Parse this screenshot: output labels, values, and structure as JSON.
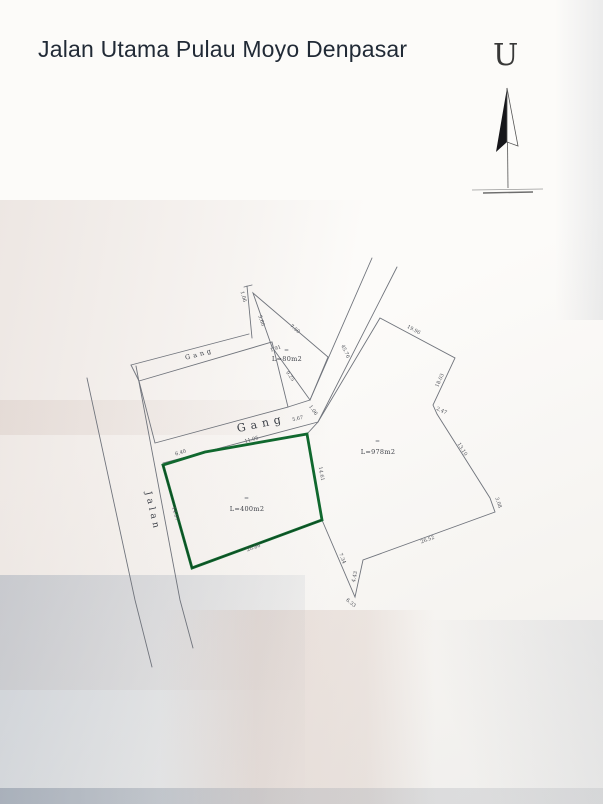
{
  "title": "Jalan Utama Pulau Moyo Denpasar",
  "north": {
    "label": "U"
  },
  "roads": {
    "jalan": "Jalan",
    "gang_top": "Gang",
    "gang_mid": "Gang",
    "road_length": "45.76"
  },
  "plots": {
    "green": {
      "area": "L=400m2",
      "dim_top_left": "6.40",
      "dim_top": "11.05",
      "dim_right": "14.61",
      "dim_bottom": "20.86",
      "dim_left": "14.97"
    },
    "east": {
      "area": "L=978m2",
      "dim_north": "19.96",
      "dim_northeast": "18.03",
      "dim_jog": "2.47",
      "dim_east": "13.10",
      "dim_southeast": "3.08",
      "dim_south": "26.52",
      "dim_southwest": "4.43",
      "dim_vertex": "6.33",
      "dim_west": "7.34"
    },
    "small": {
      "area": "L=80m2",
      "dim_corridor": "1.06",
      "dim_left": "5.60",
      "dim_hyp": "7.50",
      "dim_inner": "1.91",
      "dim_bottom": "9.25"
    },
    "gang_edge": {
      "dim_a": "5.67",
      "dim_b": "1.06"
    }
  },
  "colors": {
    "plot_highlight": "#10682e",
    "ink": "#70747c",
    "title_text": "#212a36"
  }
}
